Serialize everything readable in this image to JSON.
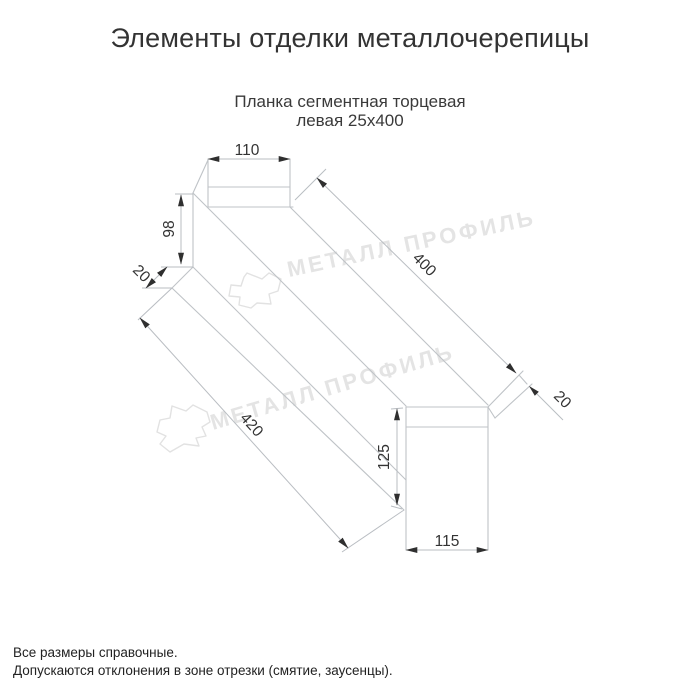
{
  "page": {
    "title": "Элементы отделки металлочерепицы",
    "subtitle_line1": "Планка сегментная торцевая",
    "subtitle_line2": "левая 25х400"
  },
  "dimensions": {
    "left_face_width": "110",
    "left_face_height": "98",
    "left_hem": "20",
    "length_top": "400",
    "length_bottom": "420",
    "right_face_height": "125",
    "right_face_width": "115",
    "right_hem": "20"
  },
  "watermark": {
    "text": "МЕТАЛЛ ПРОФИЛЬ"
  },
  "footer": {
    "line1": "Все размеры справочные.",
    "line2": "Допускаются отклонения в зоне отрезки (смятие, заусенцы)."
  },
  "colors": {
    "drawing_line": "#bfc3c7",
    "dimension_text": "#333333",
    "arrow": "#2f2f2f",
    "watermark": "#e4e4e4"
  }
}
